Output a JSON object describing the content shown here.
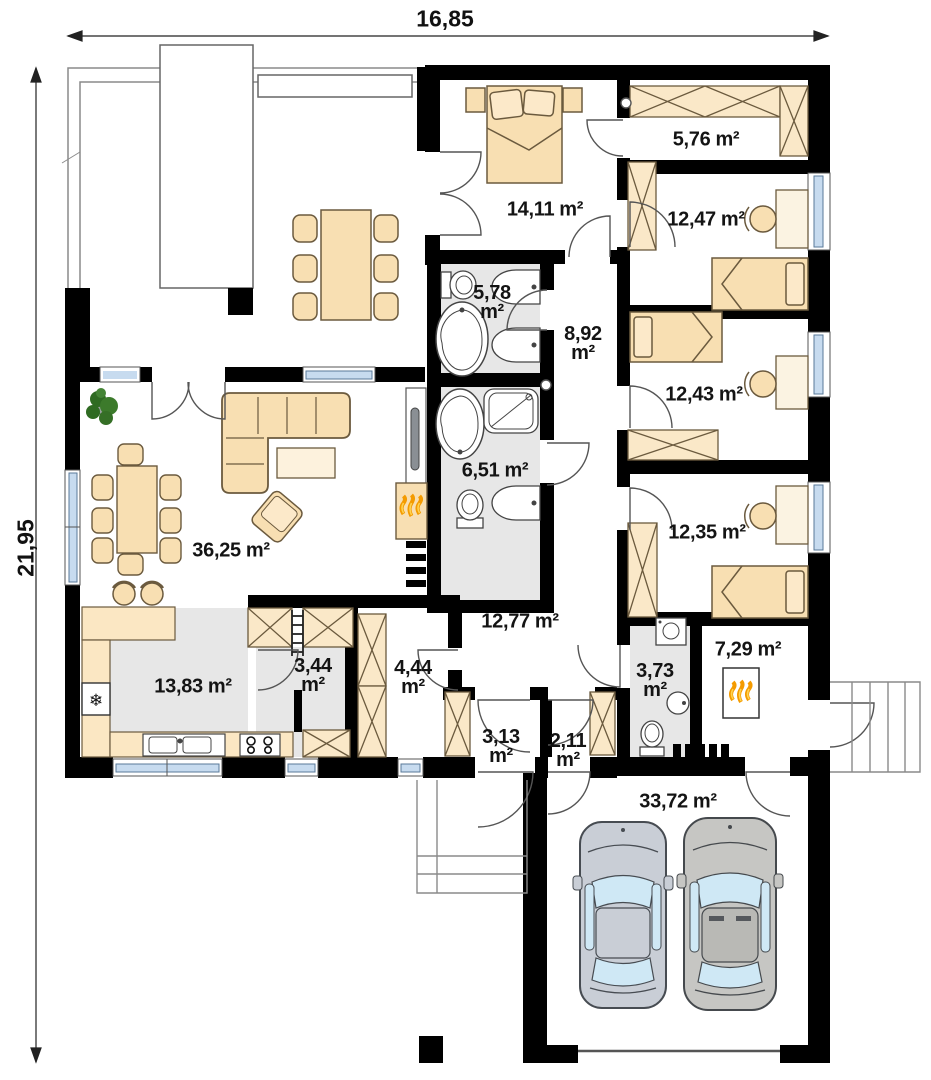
{
  "dimensions": {
    "width_m": "16,85",
    "depth_m": "21,95"
  },
  "unit_suffix": "m²",
  "rooms": {
    "living_room": {
      "area": "36,25"
    },
    "master_bedroom": {
      "area": "14,11"
    },
    "wardrobe": {
      "area": "5,76"
    },
    "bedroom_top": {
      "area": "12,47"
    },
    "bathroom_small": {
      "area": "5,78"
    },
    "hall_bedrooms": {
      "area": "8,92"
    },
    "bedroom_middle": {
      "area": "12,43"
    },
    "bathroom_main": {
      "area": "6,51"
    },
    "bedroom_bottom": {
      "area": "12,35"
    },
    "hallway": {
      "area": "12,77"
    },
    "kitchen": {
      "area": "13,83"
    },
    "pantry": {
      "area": "3,44"
    },
    "closet": {
      "area": "4,44"
    },
    "vestibule": {
      "area": "3,13"
    },
    "entry": {
      "area": "2,11"
    },
    "utility_wc": {
      "area": "3,73"
    },
    "boiler_room": {
      "area": "7,29"
    },
    "garage": {
      "area": "33,72"
    }
  },
  "icons": {
    "fridge_glyph": "❄"
  }
}
